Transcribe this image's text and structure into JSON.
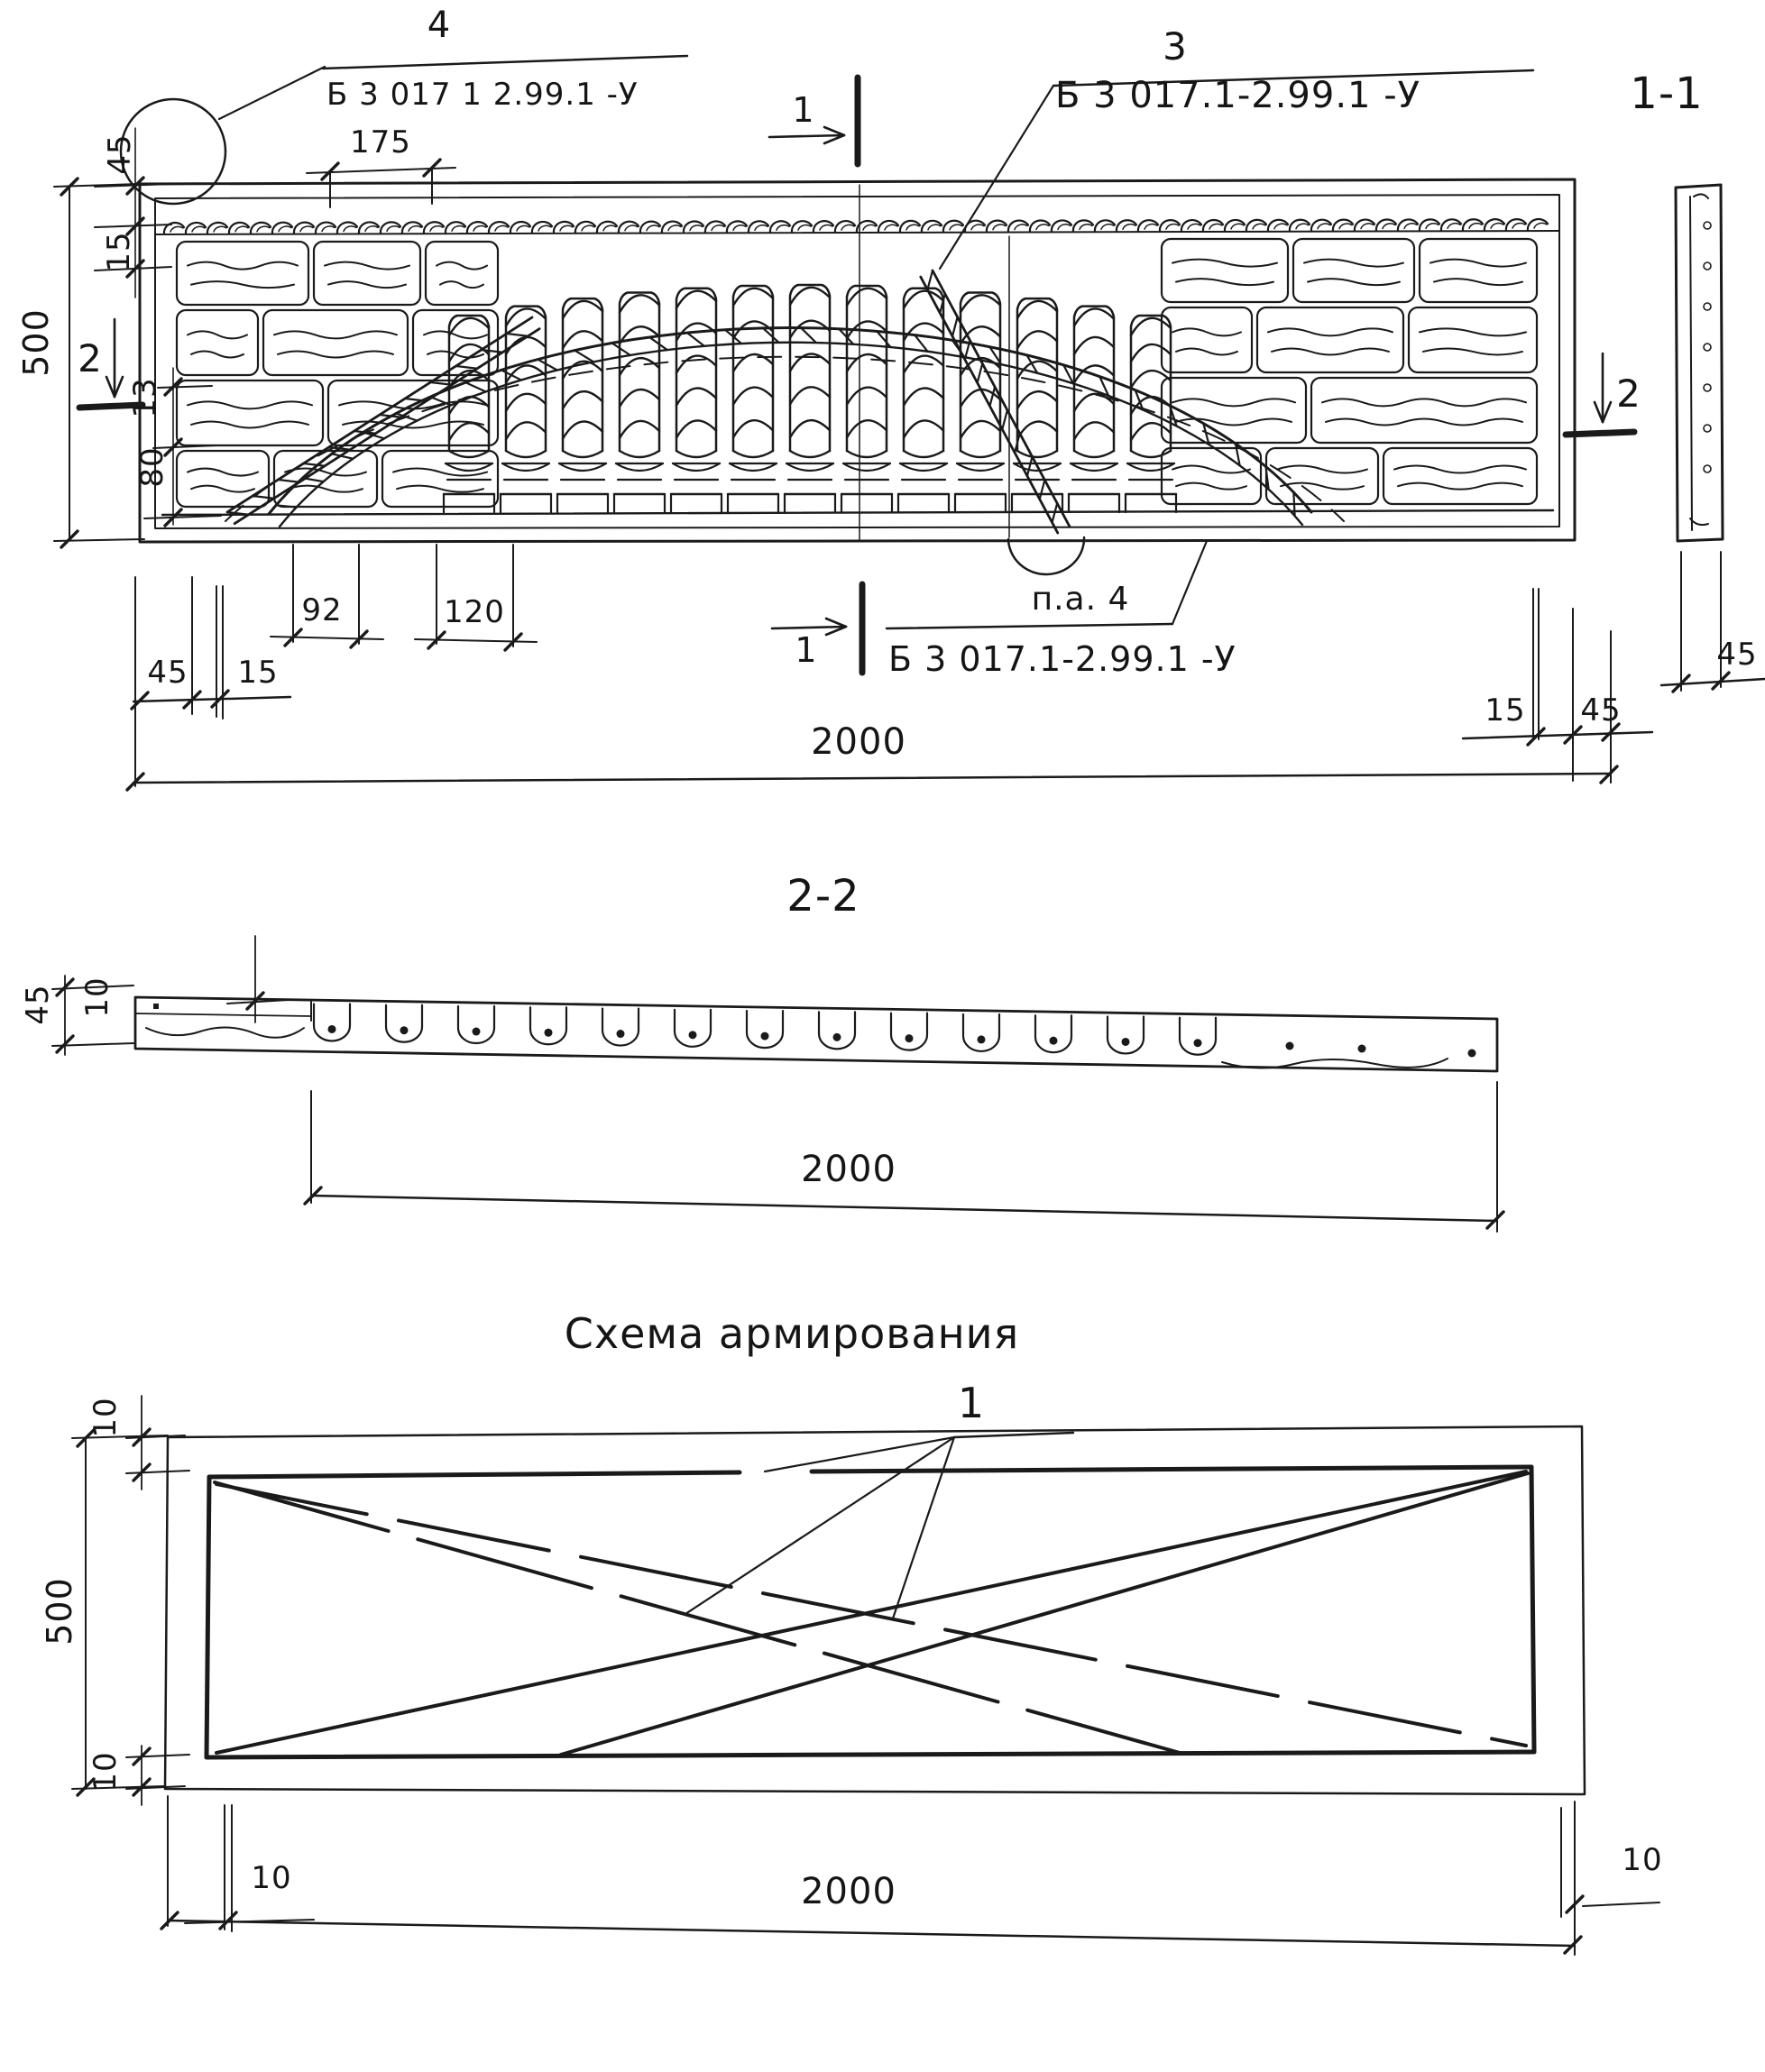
{
  "drawing": {
    "ink": "#1a1a1a",
    "main_view": {
      "callout_4": {
        "num": "4",
        "code": "Б 3 017 1 2.99.1  -У"
      },
      "callout_3": {
        "num": "3",
        "code": "Б 3 017.1-2.99.1  -У"
      },
      "callout_pa4": {
        "label": "п.а.  4",
        "code": "Б 3 017.1-2.99.1  -У"
      },
      "section_marks": {
        "s1": "1",
        "s2": "2"
      },
      "section_11_title": "1-1",
      "dims": {
        "top_offset": "45",
        "band_gap": "15",
        "height": "500",
        "row_13": "13",
        "row_80": "80",
        "block_175": "175",
        "bal_92": "92",
        "bal_120": "120",
        "left_45": "45",
        "left_15": "15",
        "length_2000": "2000",
        "right_15": "15",
        "right_45": "45",
        "sec11_45": "45"
      }
    },
    "section_22": {
      "title": "2-2",
      "thick_45": "45",
      "offset_10": "10",
      "length_2000": "2000"
    },
    "scheme": {
      "title": "Схема армирования",
      "callout_1": "1",
      "top_10": "10",
      "height_500": "500",
      "bot_10a": "10",
      "bot_10b": "10",
      "right_10": "10",
      "length_2000": "2000"
    }
  }
}
